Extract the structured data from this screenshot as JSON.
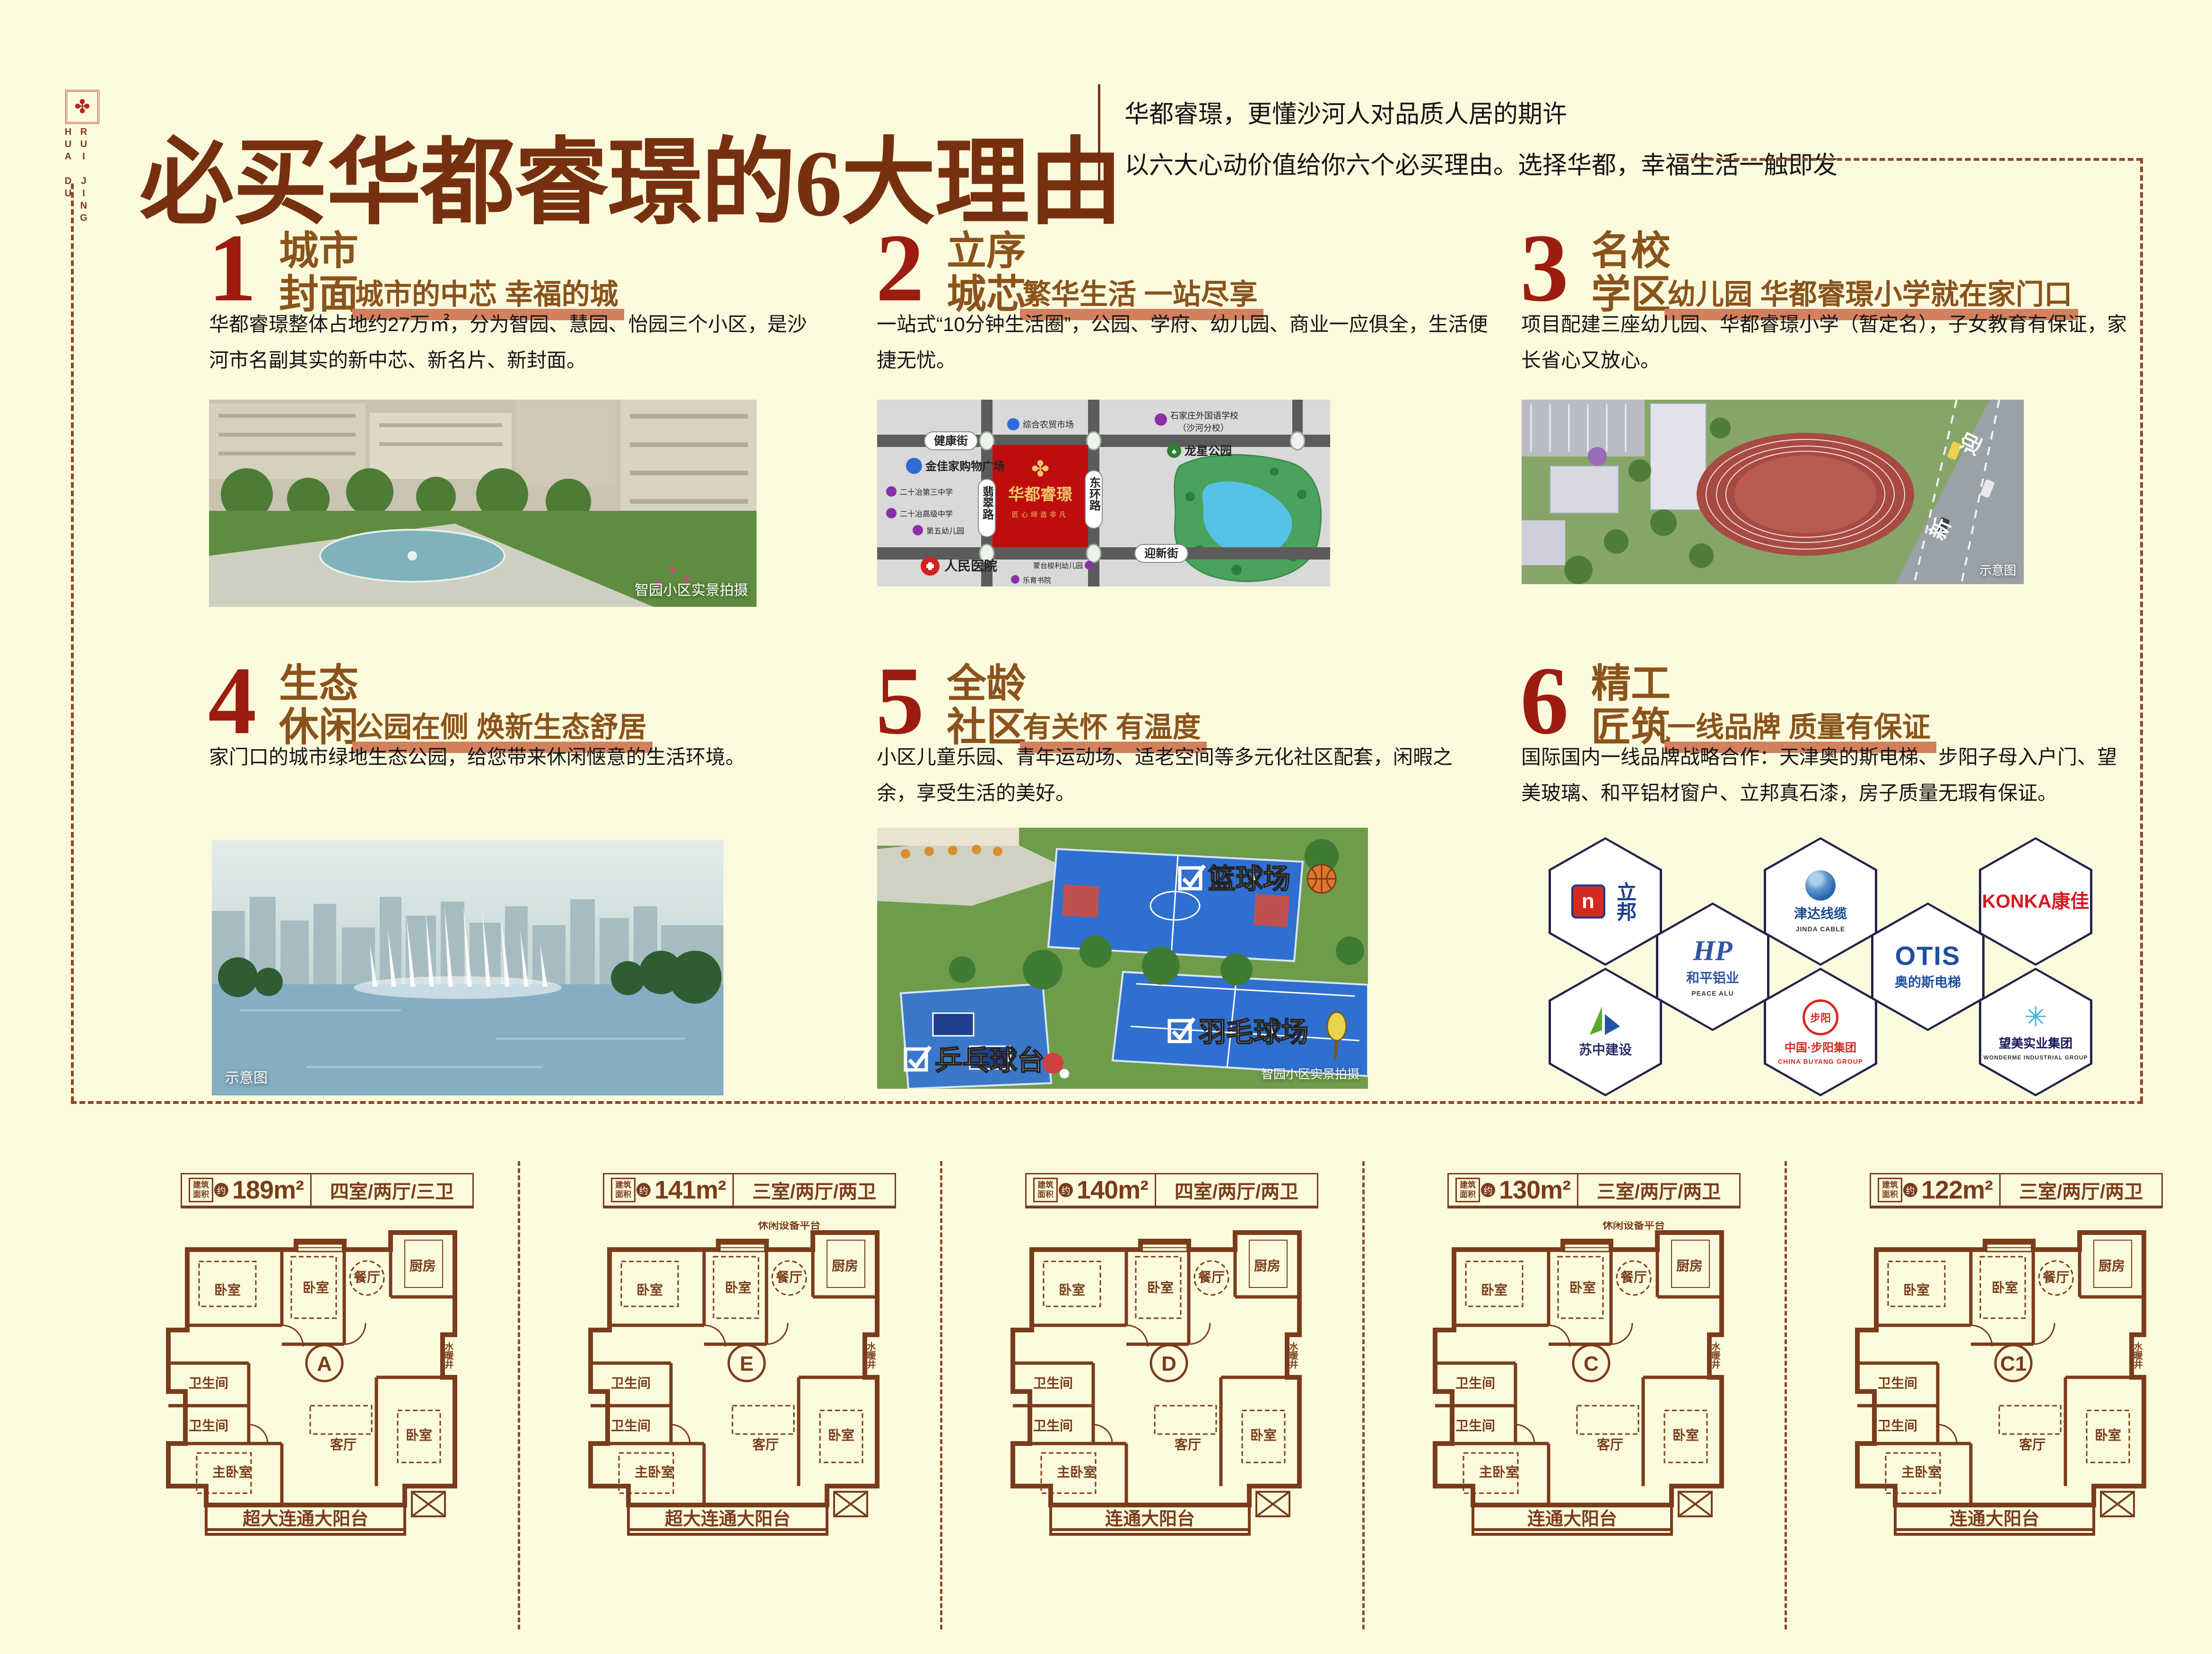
{
  "colors": {
    "background": "#fbfadd",
    "accent_red": "#9c1c10",
    "header_brown": "#76300f",
    "section_title_brown": "#8a531c",
    "underline_salmon": "#d2805e",
    "plan_line_brown": "#7a3c1b",
    "map_block_red": "#bf0d0d",
    "court_blue": "#2f6fd0"
  },
  "logo": {
    "vertical_text_1": "HUA DU",
    "vertical_text_2": "RUI JING",
    "emblem": "✤"
  },
  "header": {
    "title": "必买华都睿璟的6大理由",
    "subtitle_line1": "华都睿璟，更懂沙河人对品质人居的期许",
    "subtitle_line2": "以六大心动价值给你六个必买理由。选择华都，幸福生活一触即发"
  },
  "reasons": [
    {
      "num": "1",
      "title_line1": "城市",
      "title_line2": "封面",
      "subtitle": "城市的中芯 幸福的城",
      "body": "华都睿璟整体占地约27万㎡，分为智园、慧园、怡园三个小区，是沙河市名副其实的新中芯、新名片、新封面。",
      "caption": "智园小区实景拍摄"
    },
    {
      "num": "2",
      "title_line1": "立序",
      "title_line2": "城芯",
      "subtitle": "繁华生活 一站尽享",
      "body": "一站式“10分钟生活圈”，公园、学府、幼儿园、商业一应俱全，生活便捷无忧。"
    },
    {
      "num": "3",
      "title_line1": "名校",
      "title_line2": "学区",
      "subtitle": "幼儿园 华都睿璟小学就在家门口",
      "body": "项目配建三座幼儿园、华都睿璟小学（暂定名），子女教育有保证，家长省心又放心。",
      "caption": "示意图",
      "road_text_1": "迎",
      "road_text_2": "新"
    },
    {
      "num": "4",
      "title_line1": "生态",
      "title_line2": "休闲",
      "subtitle": "公园在侧 焕新生态舒居",
      "body": "家门口的城市绿地生态公园，给您带来休闲惬意的生活环境。",
      "caption": "示意图"
    },
    {
      "num": "5",
      "title_line1": "全龄",
      "title_line2": "社区",
      "subtitle": "有关怀 有温度",
      "body": "小区儿童乐园、青年运动场、适老空间等多元化社区配套，闲暇之余，享受生活的美好。",
      "caption": "智园小区实景拍摄",
      "tags": [
        "篮球场",
        "羽毛球场",
        "乒乓球台"
      ]
    },
    {
      "num": "6",
      "title_line1": "精工",
      "title_line2": "匠筑",
      "subtitle": "一线品牌 质量有保证",
      "body": "国际国内一线品牌战略合作：天津奥的斯电梯、步阳子母入户门、望美玻璃、和平铝材窗户、立邦真石漆，房子质量无瑕有保证。"
    }
  ],
  "map": {
    "road_h1": "健康街",
    "road_v1": "翡翠路",
    "road_v2": "东环路",
    "road_h2": "迎新街",
    "project": "华都睿璟",
    "slogan": "匠心缔造非凡",
    "park": "龙星公园",
    "pois": [
      "综合农贸市场",
      "石家庄外国语学校",
      "（沙河分校）",
      "金佳家购物广场",
      "二十冶第三中学",
      "二十冶高级中学",
      "第五幼儿园",
      "人民医院",
      "蒙台梭利幼儿园",
      "乐育书院"
    ]
  },
  "brands": [
    {
      "glyph": "n",
      "name": "立邦",
      "color": "#1b3a8c"
    },
    {
      "glyph": "HP",
      "name": "和平铝业",
      "sub": "PEACE ALU",
      "color": "#2f55a4"
    },
    {
      "glyph": "",
      "name": "津达线缆",
      "sub": "JINDA CABLE",
      "color": "#174a8c"
    },
    {
      "glyph": "OTIS",
      "name": "奥的斯电梯",
      "color": "#1d4f9e"
    },
    {
      "glyph": "KONKA康佳",
      "name": "",
      "color": "#d61920"
    },
    {
      "glyph": "◣",
      "name": "苏中建设",
      "color": "#2b2b6a"
    },
    {
      "glyph": "步阳",
      "name": "中国·步阳集团",
      "sub": "CHINA BUYANG GROUP",
      "color": "#d5281e"
    },
    {
      "glyph": "✳",
      "name": "望美实业集团",
      "sub": "WONDERME INDUSTRIAL GROUP",
      "color": "#16165a"
    }
  ],
  "plan_meta": {
    "area_label_top": "建筑",
    "area_label_bottom": "面积",
    "approx": "约"
  },
  "plan_rooms": {
    "bed": "卧室",
    "bed2": "卧室",
    "dining": "餐厅",
    "kitchen": "厨房",
    "bath": "卫生间",
    "bath2": "卫生间",
    "master": "主卧室",
    "living": "客厅",
    "bed3": "卧室",
    "shaft": "水暖井"
  },
  "floor_plans": [
    {
      "area": "189m²",
      "rooms": "四室/两厅/三卫",
      "letter": "A",
      "balcony": "超大连通大阳台",
      "top_label": ""
    },
    {
      "area": "141m²",
      "rooms": "三室/两厅/两卫",
      "letter": "E",
      "balcony": "超大连通大阳台",
      "top_label": "休闲设备平台"
    },
    {
      "area": "140m²",
      "rooms": "四室/两厅/两卫",
      "letter": "D",
      "balcony": "连通大阳台",
      "top_label": ""
    },
    {
      "area": "130m²",
      "rooms": "三室/两厅/两卫",
      "letter": "C",
      "balcony": "连通大阳台",
      "top_label": "休闲设备平台"
    },
    {
      "area": "122m²",
      "rooms": "三室/两厅/两卫",
      "letter": "C1",
      "balcony": "连通大阳台",
      "top_label": ""
    }
  ]
}
